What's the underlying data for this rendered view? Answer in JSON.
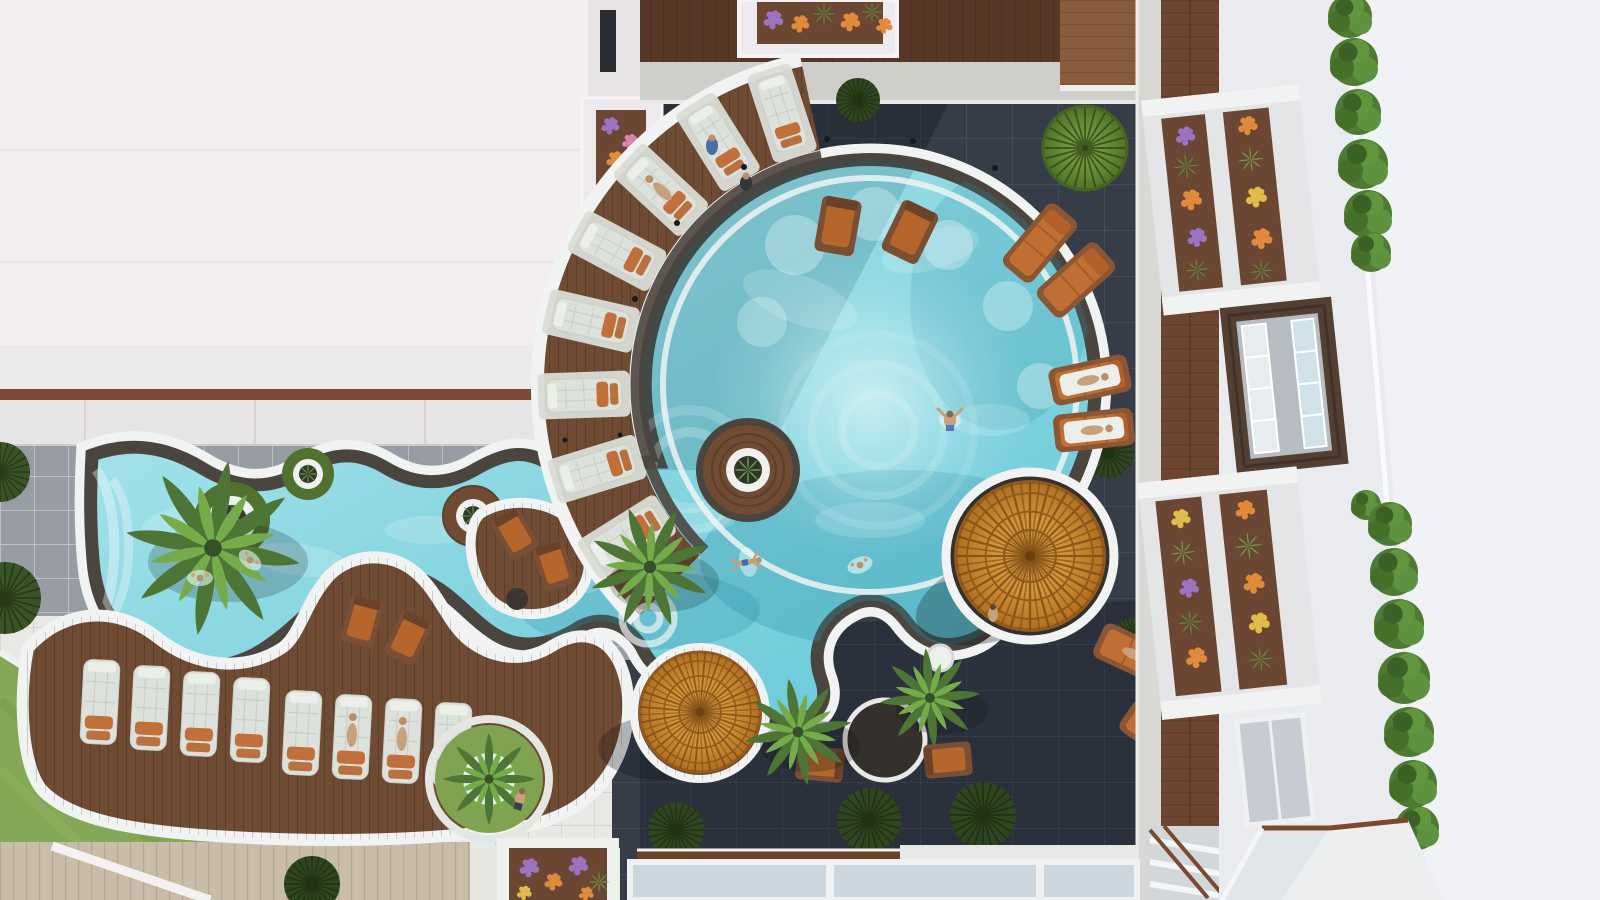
{
  "scene": {
    "type": "aerial-photograph",
    "subject": "Top-down drone view of a modern resort courtyard with a free-form swimming pool",
    "elements": "round main pool connected to a winding lazy-river pool, spiral wooden lounger deck, two amber slatted parasols, palm trees, dark charcoal tile plaza, white tile plaza with lawn, balconies with flower planters, hedge-lined white rooftop"
  },
  "colors": {
    "roof_white": "#f3eff1",
    "building_white": "#e9ebee",
    "building_bright": "#f0f2f5",
    "plaza_tile": "#e8e9e5",
    "gray_tile": "#989da5",
    "courtyard_tile": "#363d48",
    "lawn": "#84a855",
    "grass_dark": "#2e451f",
    "wood_deck": "#6f4b33",
    "wood_dark": "#573827",
    "wood_light": "#8a5c3e",
    "walkway_wood": "#6e452f",
    "boardwalk": "#c9bda9",
    "path_concrete": "#cfcecb",
    "skylight": "#ccd6de",
    "water_main": "#8fd9e3",
    "water_deep": "#55bfd2",
    "water_pale": "#c2eef2",
    "curb_white": "#f0f3f2",
    "stone_edge": "#4a453e",
    "parasol_amber": "#c98a32",
    "cushion_orange": "#c2703b",
    "lounger_white": "#dce0da",
    "palm_green": "#5f8c40",
    "hedge_green": "#4e7a33",
    "flower_orange": "#e08a3c",
    "flower_purple": "#9d72c0",
    "flower_pink": "#d684b0",
    "flower_yellow": "#e3bb4a",
    "skin": "#c9a07c"
  },
  "objects": {
    "pools": {
      "main_pool": "large round free-form pool with submerged seating circles",
      "lazy_river": "winding wavy pool with white curbs and planter islands"
    },
    "furniture": {
      "white_loungers": 8,
      "spiral_deck_pads": 8,
      "orange_sun_loungers": 6,
      "orange_deck_chairs": 2,
      "wooden_armchairs": 6,
      "side_tables": 2,
      "parasols": 2
    },
    "vegetation": {
      "palm_trees": 5,
      "hedge_bushes": 14,
      "flower_planter_boxes": 8,
      "pool_planter_islands": 4,
      "grass_and_fern_circles": 12
    },
    "people": {
      "swimmers": 5,
      "sunbathers": 7,
      "standing_or_walking": 4
    }
  }
}
